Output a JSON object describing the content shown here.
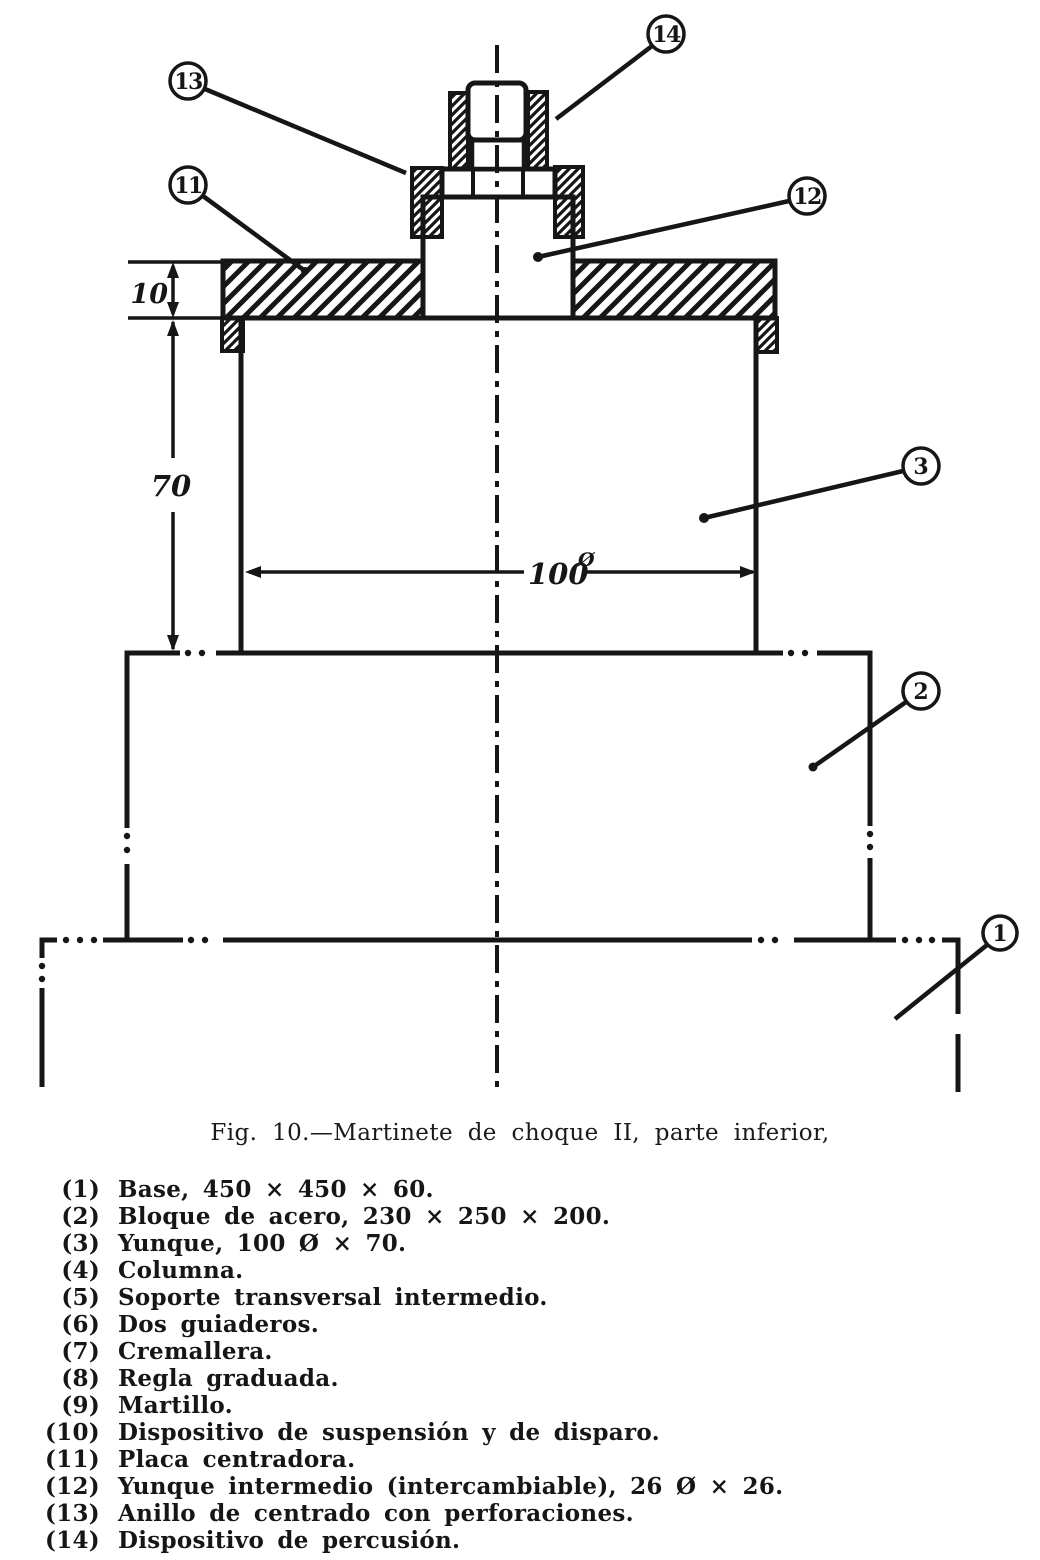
{
  "figure": {
    "caption": "Fig. 10.—Martinete de choque II, parte inferior,",
    "dimensions": {
      "plate_thickness": "10",
      "anvil_height": "70",
      "anvil_diameter": "100",
      "diameter_symbol": "Ø"
    },
    "callouts": {
      "c1": "1",
      "c2": "2",
      "c3": "3",
      "c11": "11",
      "c12": "12",
      "c13": "13",
      "c14": "14"
    }
  },
  "parts_list": [
    {
      "number": "(1)",
      "label": "Base, 450 × 450 × 60."
    },
    {
      "number": "(2)",
      "label": "Bloque de acero, 230 × 250 × 200."
    },
    {
      "number": "(3)",
      "label": "Yunque, 100 Ø × 70."
    },
    {
      "number": "(4)",
      "label": "Columna."
    },
    {
      "number": "(5)",
      "label": "Soporte transversal intermedio."
    },
    {
      "number": "(6)",
      "label": "Dos guiaderos."
    },
    {
      "number": "(7)",
      "label": "Cremallera."
    },
    {
      "number": "(8)",
      "label": "Regla graduada."
    },
    {
      "number": "(9)",
      "label": "Martillo."
    },
    {
      "number": "(10)",
      "label": "Dispositivo de suspensión y de disparo."
    },
    {
      "number": "(11)",
      "label": "Placa centradora."
    },
    {
      "number": "(12)",
      "label": "Yunque intermedio (intercambiable), 26 Ø × 26."
    },
    {
      "number": "(13)",
      "label": "Anillo de centrado con perforaciones."
    },
    {
      "number": "(14)",
      "label": "Dispositivo de percusión."
    }
  ]
}
